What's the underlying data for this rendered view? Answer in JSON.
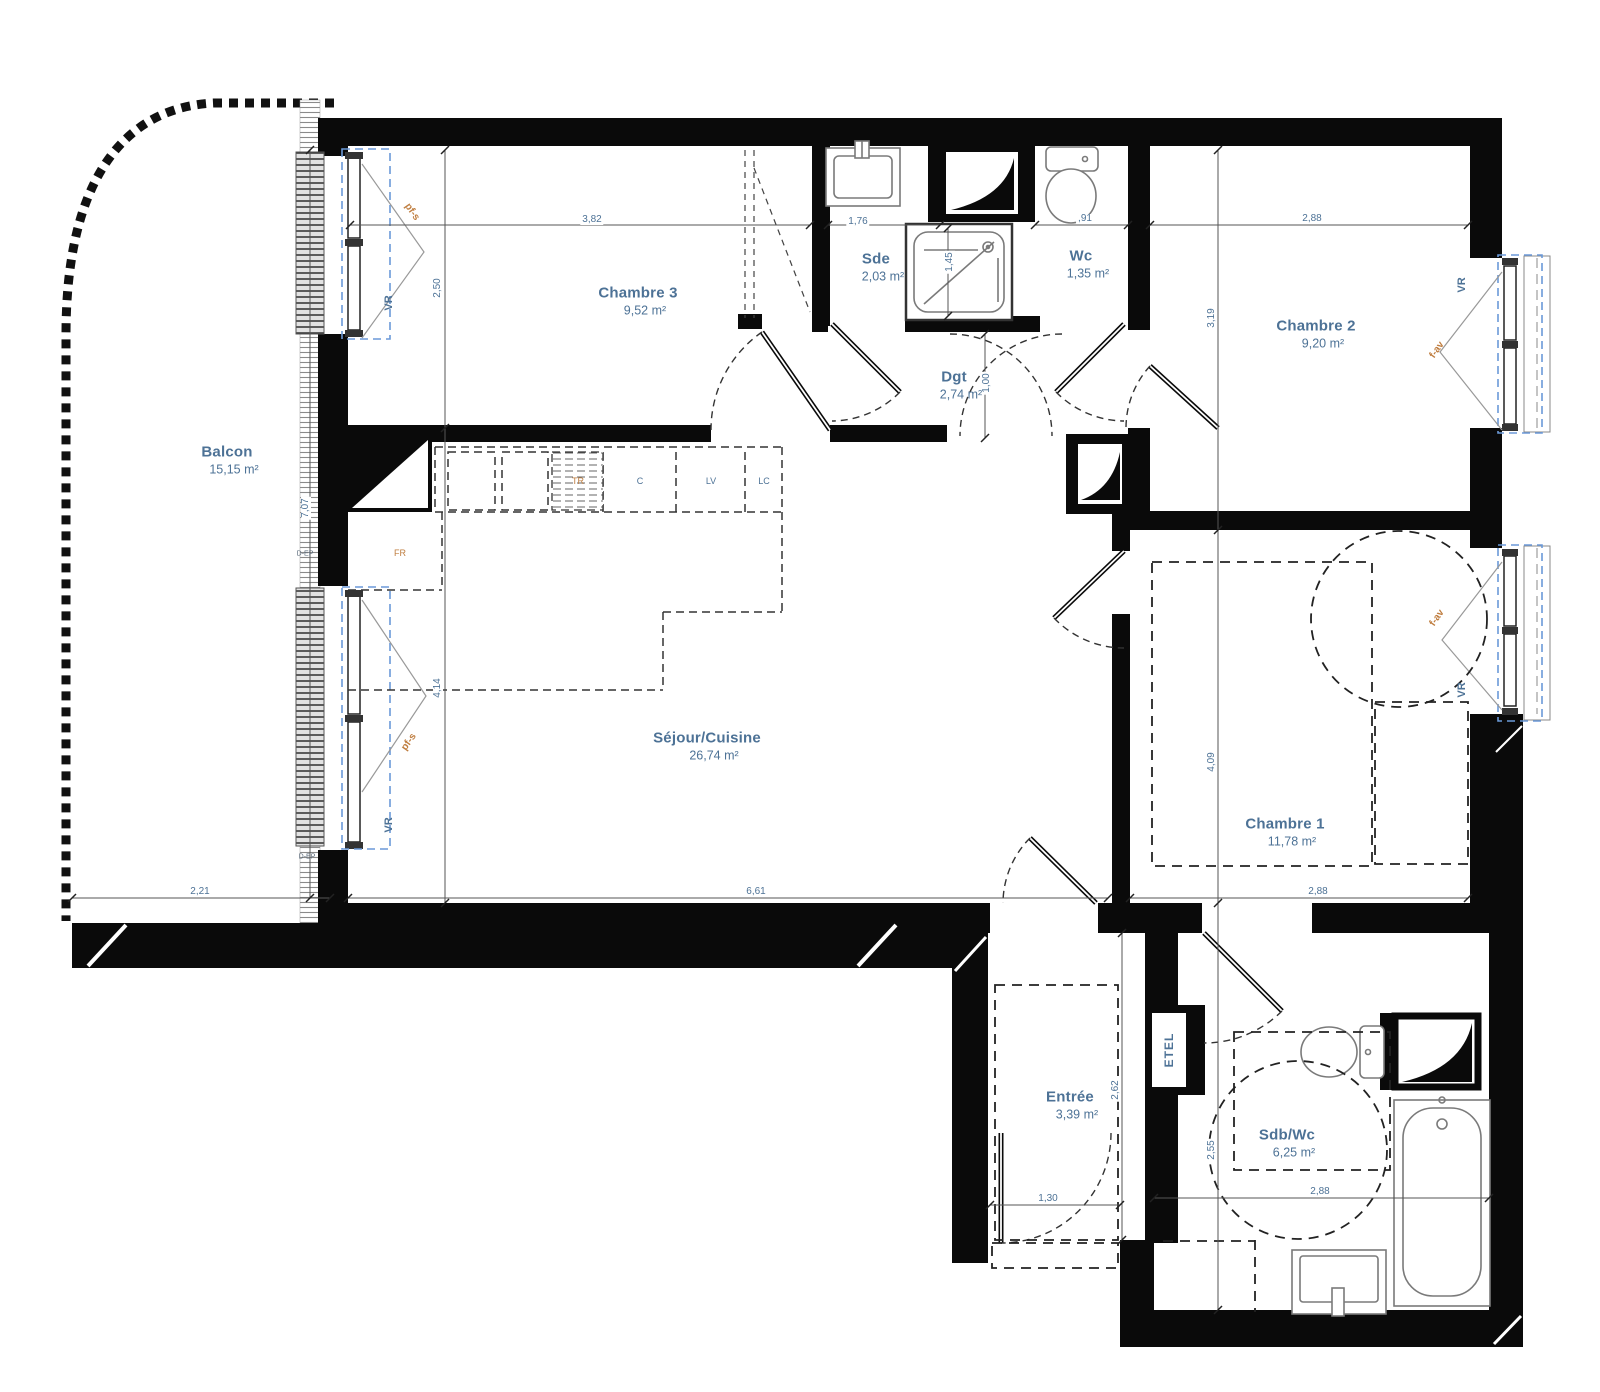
{
  "rooms": {
    "balcon": {
      "name": "Balcon",
      "area": "15,15 m²"
    },
    "chambre3": {
      "name": "Chambre 3",
      "area": "9,52 m²"
    },
    "sde": {
      "name": "Sde",
      "area": "2,03 m²"
    },
    "wc": {
      "name": "Wc",
      "area": "1,35 m²"
    },
    "chambre2": {
      "name": "Chambre 2",
      "area": "9,20 m²"
    },
    "dgt": {
      "name": "Dgt",
      "area": "2,74 m²"
    },
    "sejour": {
      "name": "Séjour/Cuisine",
      "area": "26,74 m²"
    },
    "chambre1": {
      "name": "Chambre 1",
      "area": "11,78 m²"
    },
    "entree": {
      "name": "Entrée",
      "area": "3,39 m²"
    },
    "sdb": {
      "name": "Sdb/Wc",
      "area": "6,25 m²"
    }
  },
  "dimensions": {
    "ch3_width": "3,82",
    "sde_width": "1,76",
    "wc_width": ",91",
    "ch2_width_top": "2,88",
    "ch3_height": "2,50",
    "shower_height": "1,45",
    "ch2_height": "3,19",
    "dgt_width": "1,00",
    "balcon_height": "7,07",
    "sejour_height": "4,14",
    "ch1_height": "4,09",
    "entree_height": "2,62",
    "sdb_height": "2,55",
    "balcon_width": "2,21",
    "sejour_width": "6,61",
    "ch1_width": "2,88",
    "entree_width": "1,30",
    "sdb_width": "2,88"
  },
  "window_labels": {
    "vr": "VR",
    "pfs": "pf-s",
    "fav": "f-av"
  },
  "kitchen_labels": {
    "fr": "FR",
    "tr": "TR",
    "c": "C",
    "lv": "LV",
    "lc": "LC"
  },
  "fixture_labels": {
    "etel": "ETEL",
    "dep": "D-EP"
  },
  "colors": {
    "wall_black": "#0a0a0a",
    "label_blue": "#4d7296",
    "label_orange": "#bf7d3f",
    "window_blue": "#6b99d8"
  }
}
